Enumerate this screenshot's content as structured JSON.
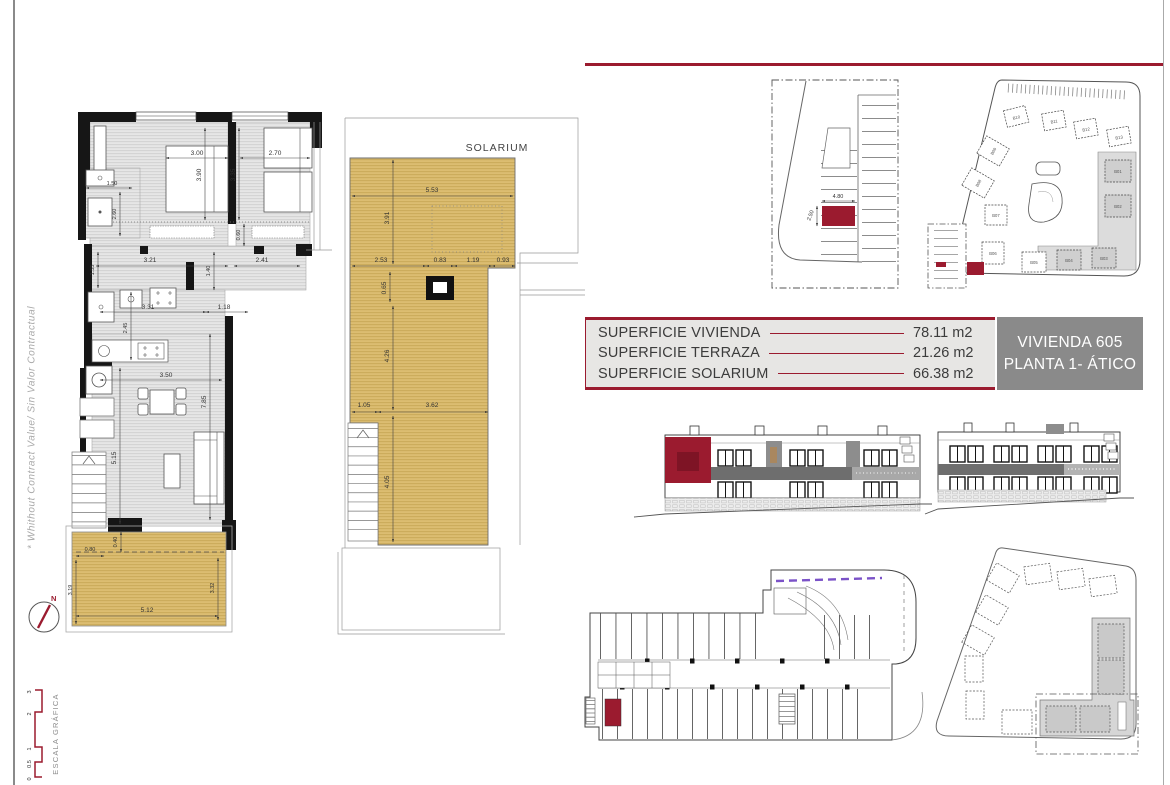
{
  "colors": {
    "accent": "#9b1b2f",
    "solarium_tan": "#d9ba6e",
    "unit_box_gray": "#8a8a8a",
    "ramp_purple": "#7b52c8",
    "table_bg": "#e7e6e4"
  },
  "page": {
    "side_note": "* Whithout Contract Value/ Sin Valor Contractual",
    "scale_label": "ESCALA GRÁFICA",
    "scale_ticks": [
      "3",
      "2",
      "1",
      "0.5",
      "0"
    ],
    "north": "N"
  },
  "summary": {
    "rows": [
      {
        "label": "SUPERFICIE VIVIENDA",
        "value": "78.11 m2"
      },
      {
        "label": "SUPERFICIE TERRAZA",
        "value": "21.26 m2"
      },
      {
        "label": "SUPERFICIE SOLARIUM",
        "value": "66.38 m2"
      }
    ],
    "unit_line1": "VIVIENDA 605",
    "unit_line2": "PLANTA 1- ÁTICO"
  },
  "floor_plan": {
    "dims": {
      "bed1_w": "3.00",
      "bed1_d": "3.90",
      "bed2_w": "2.70",
      "bed2_d": "3.35",
      "bath1_w": "1.50",
      "bath1_d": "2.60",
      "hall_n": "0.60",
      "hall_w1": "3.21",
      "hall_w2": "2.41",
      "bath2_d": "1.55",
      "hall_d": "1.40",
      "kitchen_w": "3.31",
      "entry_w": "1.18",
      "kitchen_d": "2.45",
      "living_w": "3.50",
      "living_d": "7.85",
      "living_d2": "5.15",
      "terr_a": "0.80",
      "terr_b": "0.40",
      "terr_l": "3.19",
      "terr_r": "3.32",
      "terr_w": "5.12"
    }
  },
  "solarium": {
    "title": "SOLARIUM",
    "dims": {
      "w_top": "5.53",
      "d_top": "3.91",
      "m1": "2.53",
      "m2": "0.83",
      "m3": "1.19",
      "m4": "0.93",
      "sky": "0.65",
      "d_mid": "4.26",
      "stair": "1.05",
      "w_low": "3.62",
      "d_low": "4.05"
    }
  },
  "parking": {
    "space_w": "4.80",
    "space_d": "2.50"
  },
  "site_plan": {
    "buildings": [
      "B10",
      "B11",
      "B12",
      "B13",
      "B09",
      "B08",
      "B07",
      "B06",
      "B05",
      "B04",
      "B03",
      "B02",
      "B01"
    ]
  }
}
